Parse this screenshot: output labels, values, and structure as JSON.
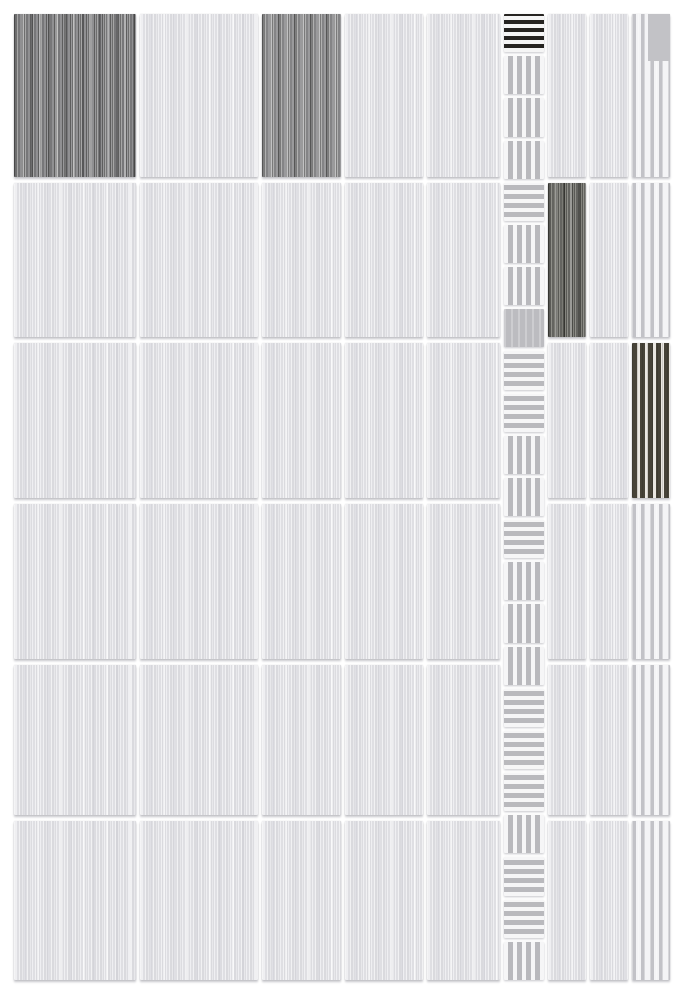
{
  "sheet": {
    "background": "#ffffff",
    "grid": {
      "left": 14,
      "top": 14,
      "col_gap": 4,
      "row_gap": 6,
      "strip_gap": 4,
      "column_widths": [
        122,
        118,
        79,
        78,
        73,
        40,
        38,
        38,
        38
      ],
      "row_heights": [
        163,
        154,
        155,
        155,
        150,
        159
      ],
      "strip_column_index": 5
    },
    "palette": {
      "background": "#ffffff",
      "tile_light_base": "#e2e2e5",
      "tile_light_highlight": "#f1f1f3",
      "tile_dark1": "#848486",
      "tile_dark2": "#909092",
      "tile_dark3": "#6e6e6a",
      "stripe_light_bg": "#f2f2f4",
      "stripe_light_band": "#c2c2c7",
      "stripe_dark_band": "#474338",
      "stripe_dark_bg": "#eae7e1",
      "mosaic_square_bg": "#b9b9bd",
      "mosaic_square_stripe": "#f6f6f7",
      "mosaic_square_black": "#262421",
      "grout_shadow": "#d8d8dc"
    },
    "rows": [
      [
        "dark1",
        "light",
        "dark2",
        "light",
        "light",
        "light",
        "light",
        "stripeL"
      ],
      [
        "light",
        "light",
        "light",
        "light",
        "light",
        "dark3",
        "light",
        "stripeL"
      ],
      [
        "light",
        "light",
        "light",
        "light",
        "light",
        "light",
        "light",
        "stripeD"
      ],
      [
        "light",
        "light",
        "light",
        "light",
        "light",
        "light",
        "light",
        "stripeL"
      ],
      [
        "light",
        "light",
        "light",
        "light",
        "light",
        "light",
        "light",
        "stripeL"
      ],
      [
        "light",
        "light",
        "light",
        "light",
        "light",
        "light",
        "light",
        "stripeL"
      ]
    ],
    "strip_squares": [
      "hDark",
      "v",
      "v",
      "v",
      "h",
      "v",
      "v",
      "plain",
      "h",
      "h",
      "v",
      "v",
      "h",
      "v",
      "v",
      "v",
      "h",
      "h",
      "h",
      "v",
      "h",
      "h",
      "v"
    ],
    "overlays": [
      {
        "row": 0,
        "col": 7,
        "type": "corner-patch"
      }
    ]
  }
}
